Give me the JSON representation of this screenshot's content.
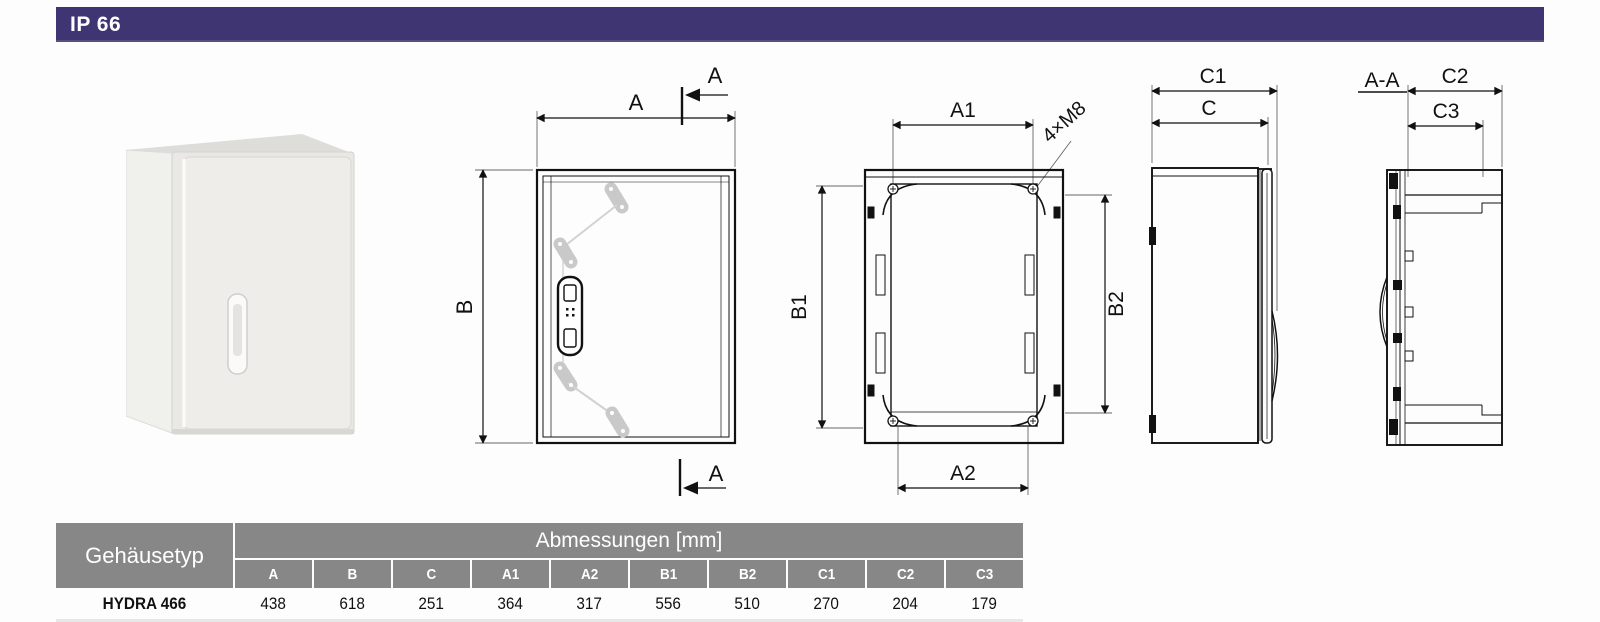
{
  "header": {
    "ip_rating": "IP 66",
    "bar_color": "#3e3572"
  },
  "drawings": {
    "front_view": {
      "dim_width": "A",
      "dim_height": "B",
      "section_mark_top": "A",
      "section_mark_bottom": "A"
    },
    "rear_view": {
      "dim_width_top": "A1",
      "dim_width_bottom": "A2",
      "dim_height_left": "B1",
      "dim_height_right": "B2",
      "thread_note": "4×M8"
    },
    "side_view": {
      "dim_depth_total": "C1",
      "dim_depth_door": "C"
    },
    "section_view": {
      "title": "A-A",
      "dim_depth_outer": "C2",
      "dim_depth_inner": "C3"
    }
  },
  "table": {
    "row_header_label": "Gehäusetyp",
    "group_header": "Abmessungen [mm]",
    "header_bg": "#878787",
    "columns": [
      "A",
      "B",
      "C",
      "A1",
      "A2",
      "B1",
      "B2",
      "C1",
      "C2",
      "C3"
    ],
    "rows": [
      {
        "name": "HYDRA 466",
        "values": [
          "438",
          "618",
          "251",
          "364",
          "317",
          "556",
          "510",
          "270",
          "204",
          "179"
        ]
      }
    ]
  }
}
